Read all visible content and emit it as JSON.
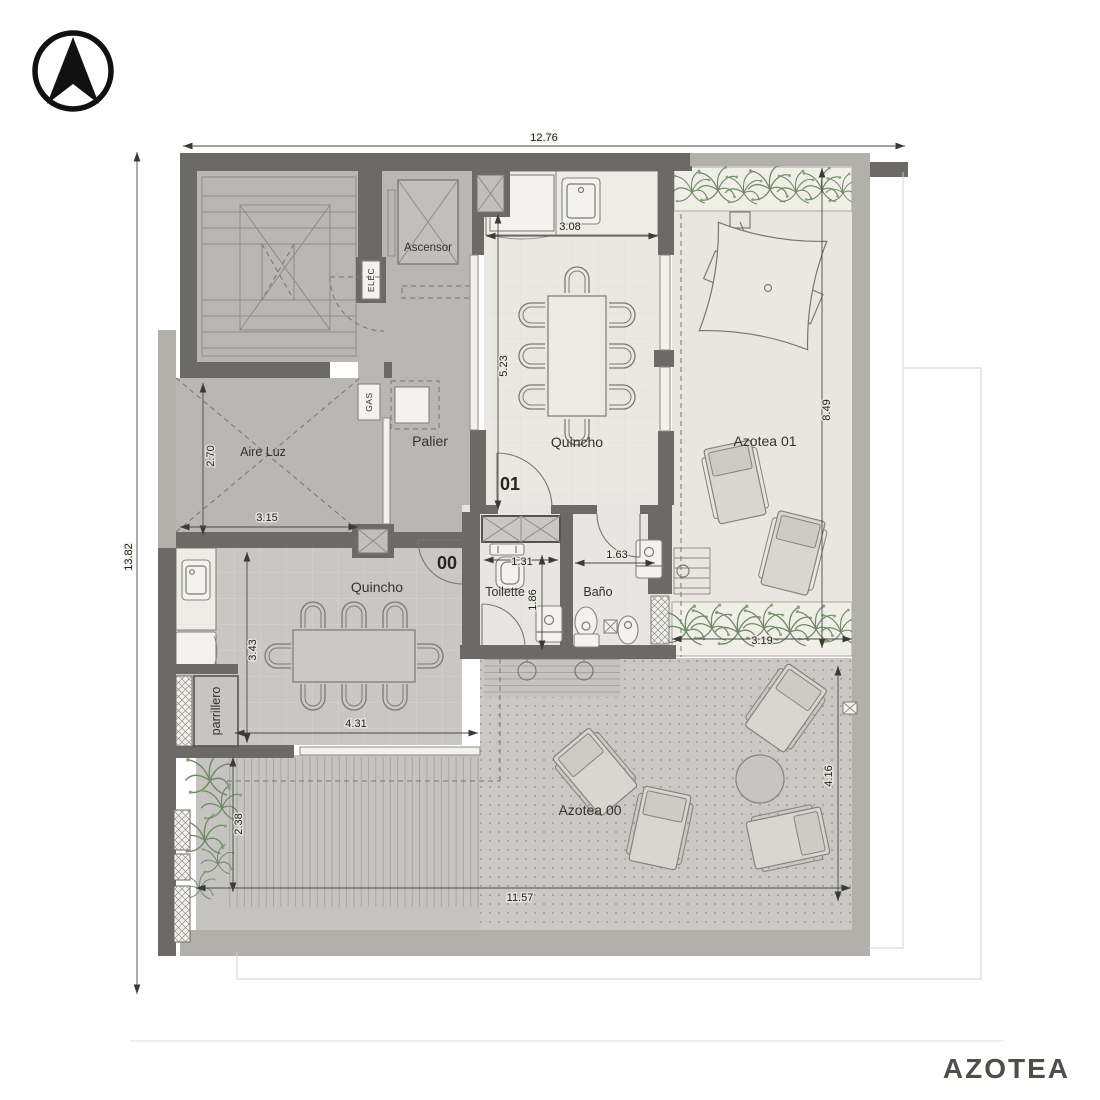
{
  "title": "AZOTEA",
  "compass": {
    "icon": "north-arrow"
  },
  "levels": {
    "upper": "01",
    "lower": "00"
  },
  "rooms": {
    "ascensor": "Ascensor",
    "palier": "Palier",
    "aire_luz": "Aire Luz",
    "quincho_upper": "Quincho",
    "quincho_lower": "Quincho",
    "toilette": "Toilette",
    "bano": "Baño",
    "azotea_01": "Azotea 01",
    "azotea_00": "Azotea 00",
    "parrillero": "parrillero"
  },
  "shafts": {
    "elec": "ELEC",
    "gas": "GAS"
  },
  "dimensions": {
    "overall_width": "12.76",
    "overall_depth": "13.82",
    "quincho_upper_width": "3.08",
    "quincho_upper_depth": "5.23",
    "azotea_01_depth": "8.49",
    "aire_luz_depth": "2.70",
    "aire_luz_width": "3.15",
    "toilette_width": "1.31",
    "toilette_depth": "1.86",
    "bano_width": "1.63",
    "quincho_lower_depth": "3.43",
    "quincho_lower_width": "4.31",
    "planter_width": "3.19",
    "deck_depth": "2.38",
    "azotea_00_width": "11.57",
    "azotea_00_depth": "4.16"
  },
  "colors": {
    "wall": "#6b6a66",
    "wall_light": "#b1b0aa",
    "accent_green": "#76876a"
  }
}
